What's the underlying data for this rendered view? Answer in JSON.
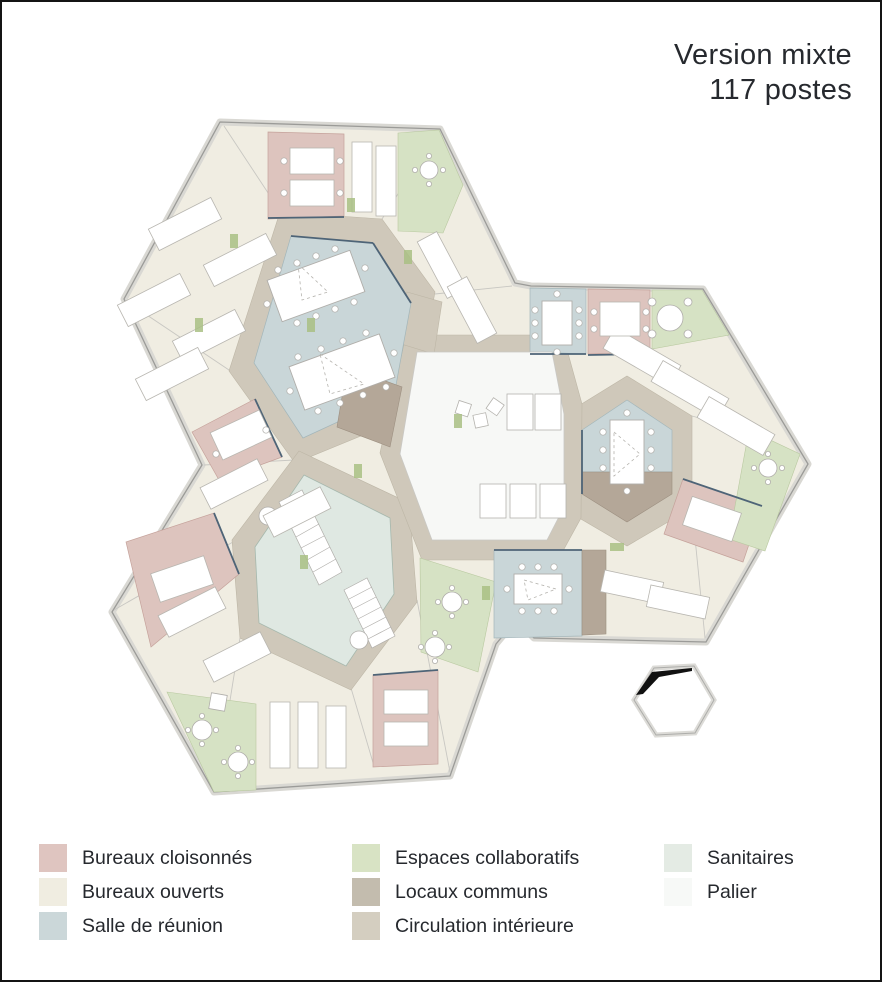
{
  "title": {
    "line1": "Version mixte",
    "line2": "117 postes"
  },
  "legend": {
    "columns": [
      {
        "items": [
          {
            "label": "Bureaux cloisonnés",
            "color": "#dfc5c0"
          },
          {
            "label": "Bureaux ouverts",
            "color": "#f0ede1"
          },
          {
            "label": "Salle de réunion",
            "color": "#cbd7d9"
          }
        ]
      },
      {
        "items": [
          {
            "label": "Espaces collaboratifs",
            "color": "#d8e3c4"
          },
          {
            "label": "Locaux communs",
            "color": "#c3bcae"
          },
          {
            "label": "Circulation intérieure",
            "color": "#d4cec0"
          }
        ]
      },
      {
        "items": [
          {
            "label": "Sanitaires",
            "color": "#e4ebe4"
          },
          {
            "label": "Palier",
            "color": "#f7f9f7"
          }
        ]
      }
    ]
  },
  "plan": {
    "colors": {
      "bureaux_cloisonnes": "#ddc4be",
      "bureaux_ouverts": "#f0ede2",
      "salle_de_reunion": "#c9d6d8",
      "espaces_collaboratifs": "#d6e2c4",
      "locaux_communs": "#b4a798",
      "circulation_interieure": "#cfc8ba",
      "sanitaires": "#dfe8e2",
      "palier": "#f7f8f6",
      "walls": "#9b9b98",
      "glazed_partition": "#4e6477",
      "north_key_mark": "#111111"
    }
  }
}
